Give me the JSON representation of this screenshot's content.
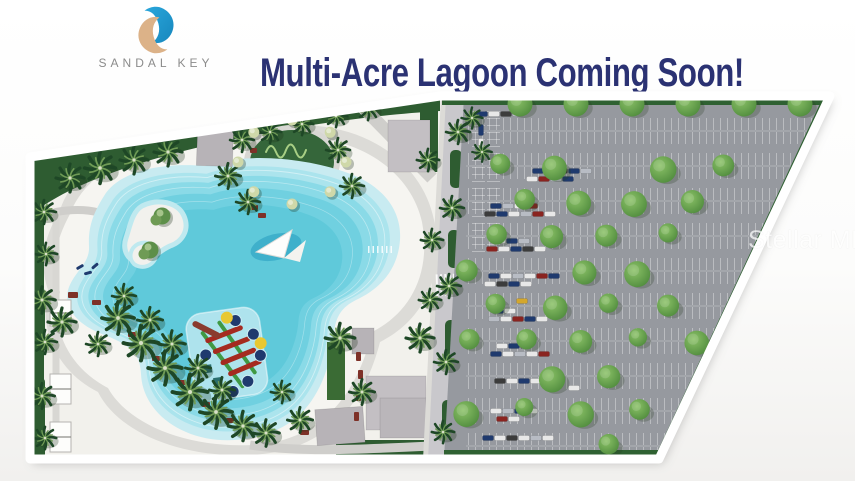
{
  "header": {
    "logo": {
      "text": "SANDAL KEY"
    },
    "headline": "Multi-Acre Lagoon Coming Soon!"
  },
  "watermark": "Stellar MLS",
  "colors": {
    "headline_navy": "#2b3273",
    "logo_gray": "#8b8b8b",
    "logo_blue": "#2aa7dc",
    "logo_blue_dark": "#1787bd",
    "logo_tan": "#dcb288",
    "sand": "#f5f4ef",
    "plaza": "#dcdbd7",
    "path": "#cfcecb",
    "lagoon_shallow": "#c8ebf1",
    "lagoon_1": "#abe4ed",
    "lagoon_2": "#8adae7",
    "lagoon_3": "#70d0e0",
    "lagoon_deep": "#5fc9da",
    "asphalt": "#96999f",
    "bed_green": "#2e5c31",
    "lawn_green": "#3a6b34",
    "tree_light": "#8cc268",
    "tree_dark": "#4e8a3c",
    "palm_dark": "#1e4726",
    "palm_light": "#6f9b55",
    "building_gray": "#b7b3b7",
    "building_gray2": "#c3bfc3",
    "accent_red": "#7e3128",
    "plan_border": "#ffffff"
  },
  "site_plan": {
    "features": [
      "multi-acre-lagoon",
      "sand-beach",
      "island",
      "floating-water-playground",
      "sail-shade",
      "palm-landscaping",
      "cabanas",
      "amenity-buildings",
      "tree-lined-parking-lot"
    ]
  }
}
